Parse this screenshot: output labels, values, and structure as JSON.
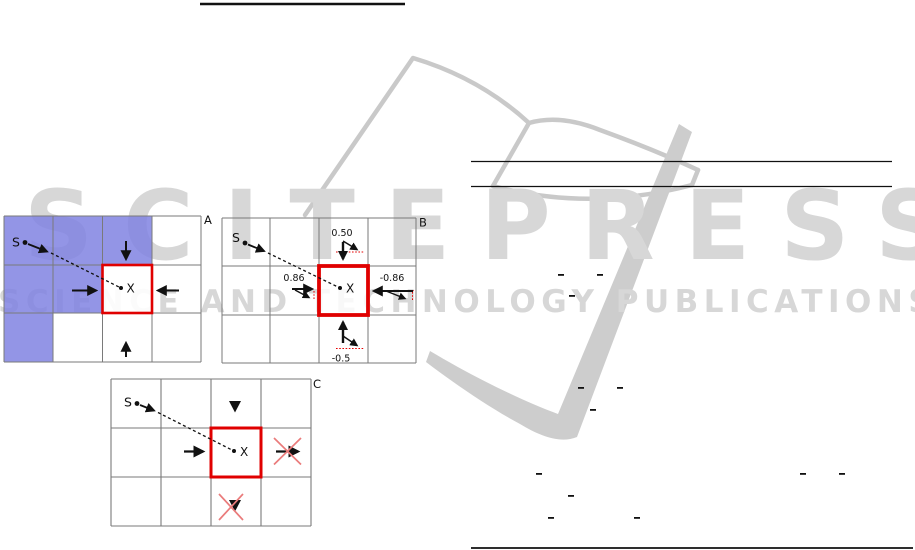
{
  "watermark": {
    "title": "SCITEPRESS",
    "subtitle": "SCIENCE AND TECHNOLOGY PUBLICATIONS",
    "color": "#d7d7d7"
  },
  "figure": {
    "panels": [
      {
        "id": "A",
        "label": "A",
        "start": "S",
        "target": "X"
      },
      {
        "id": "B",
        "label": "B",
        "start": "S",
        "target": "X",
        "weights": {
          "top": "0.50",
          "left": "0.86",
          "right": "-0.86",
          "bottom": "-0.5"
        }
      },
      {
        "id": "C",
        "label": "C",
        "start": "S",
        "target": "X"
      }
    ],
    "colors": {
      "highlight": "#8083e2",
      "target_border": "#e00000",
      "projection": "#e60000",
      "cross": "#ea7b7b"
    }
  },
  "marks": {
    "overlines": [
      [
        558,
        274
      ],
      [
        597,
        274
      ],
      [
        569,
        295
      ],
      [
        578,
        387
      ],
      [
        617,
        387
      ],
      [
        590,
        409
      ],
      [
        536,
        473
      ],
      [
        800,
        473
      ],
      [
        839,
        473
      ],
      [
        568,
        495
      ],
      [
        548,
        517
      ],
      [
        634,
        517
      ]
    ]
  }
}
